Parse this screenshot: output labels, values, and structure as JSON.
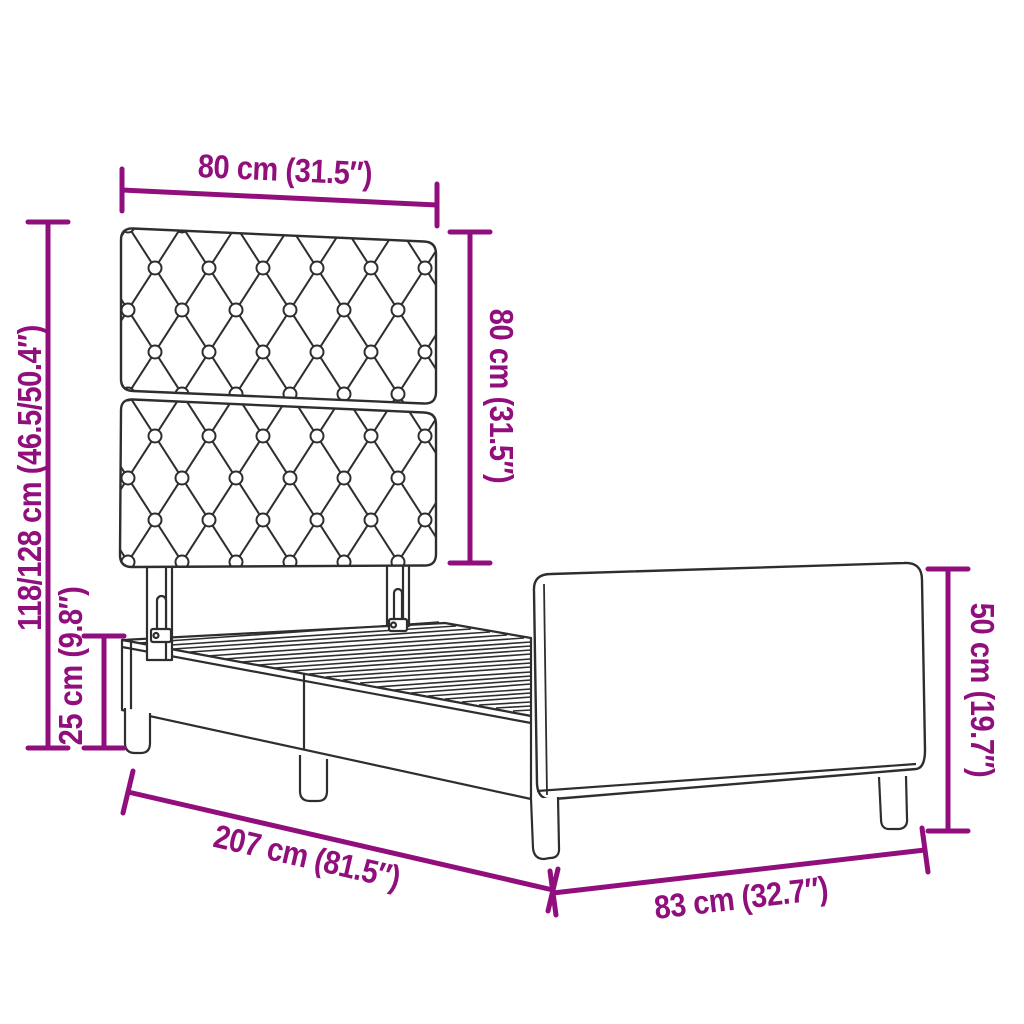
{
  "page": {
    "type": "product dimension diagram",
    "subject": "upholstered bed frame with button-tufted headboard, slatted base and footboard",
    "background": "#ffffff"
  },
  "colors": {
    "dimension_accent": "#910F7D",
    "outline": "#2E2E2E"
  },
  "labels": {
    "headboard_width": "80 cm (31.5″)",
    "headboard_height": "80 cm (31.5″)",
    "total_height": "118/128 cm (46.5/50.4″)",
    "frame_height": "25 cm (9.8″)",
    "frame_length": "207 cm (81.5″)",
    "frame_width": "83 cm (32.7″)",
    "footboard_height": "50 cm (19.7″)"
  },
  "measurements": {
    "headboard_width_cm": "80",
    "headboard_width_in": "31.5",
    "headboard_height_cm": "80",
    "headboard_height_in": "31.5",
    "total_height_cm": "118/128",
    "total_height_in": "46.5/50.4",
    "frame_height_cm": "25",
    "frame_height_in": "9.8",
    "frame_length_cm": "207",
    "frame_length_in": "81.5",
    "frame_width_cm": "83",
    "frame_width_in": "32.7",
    "footboard_height_cm": "50",
    "footboard_height_in": "19.7"
  }
}
